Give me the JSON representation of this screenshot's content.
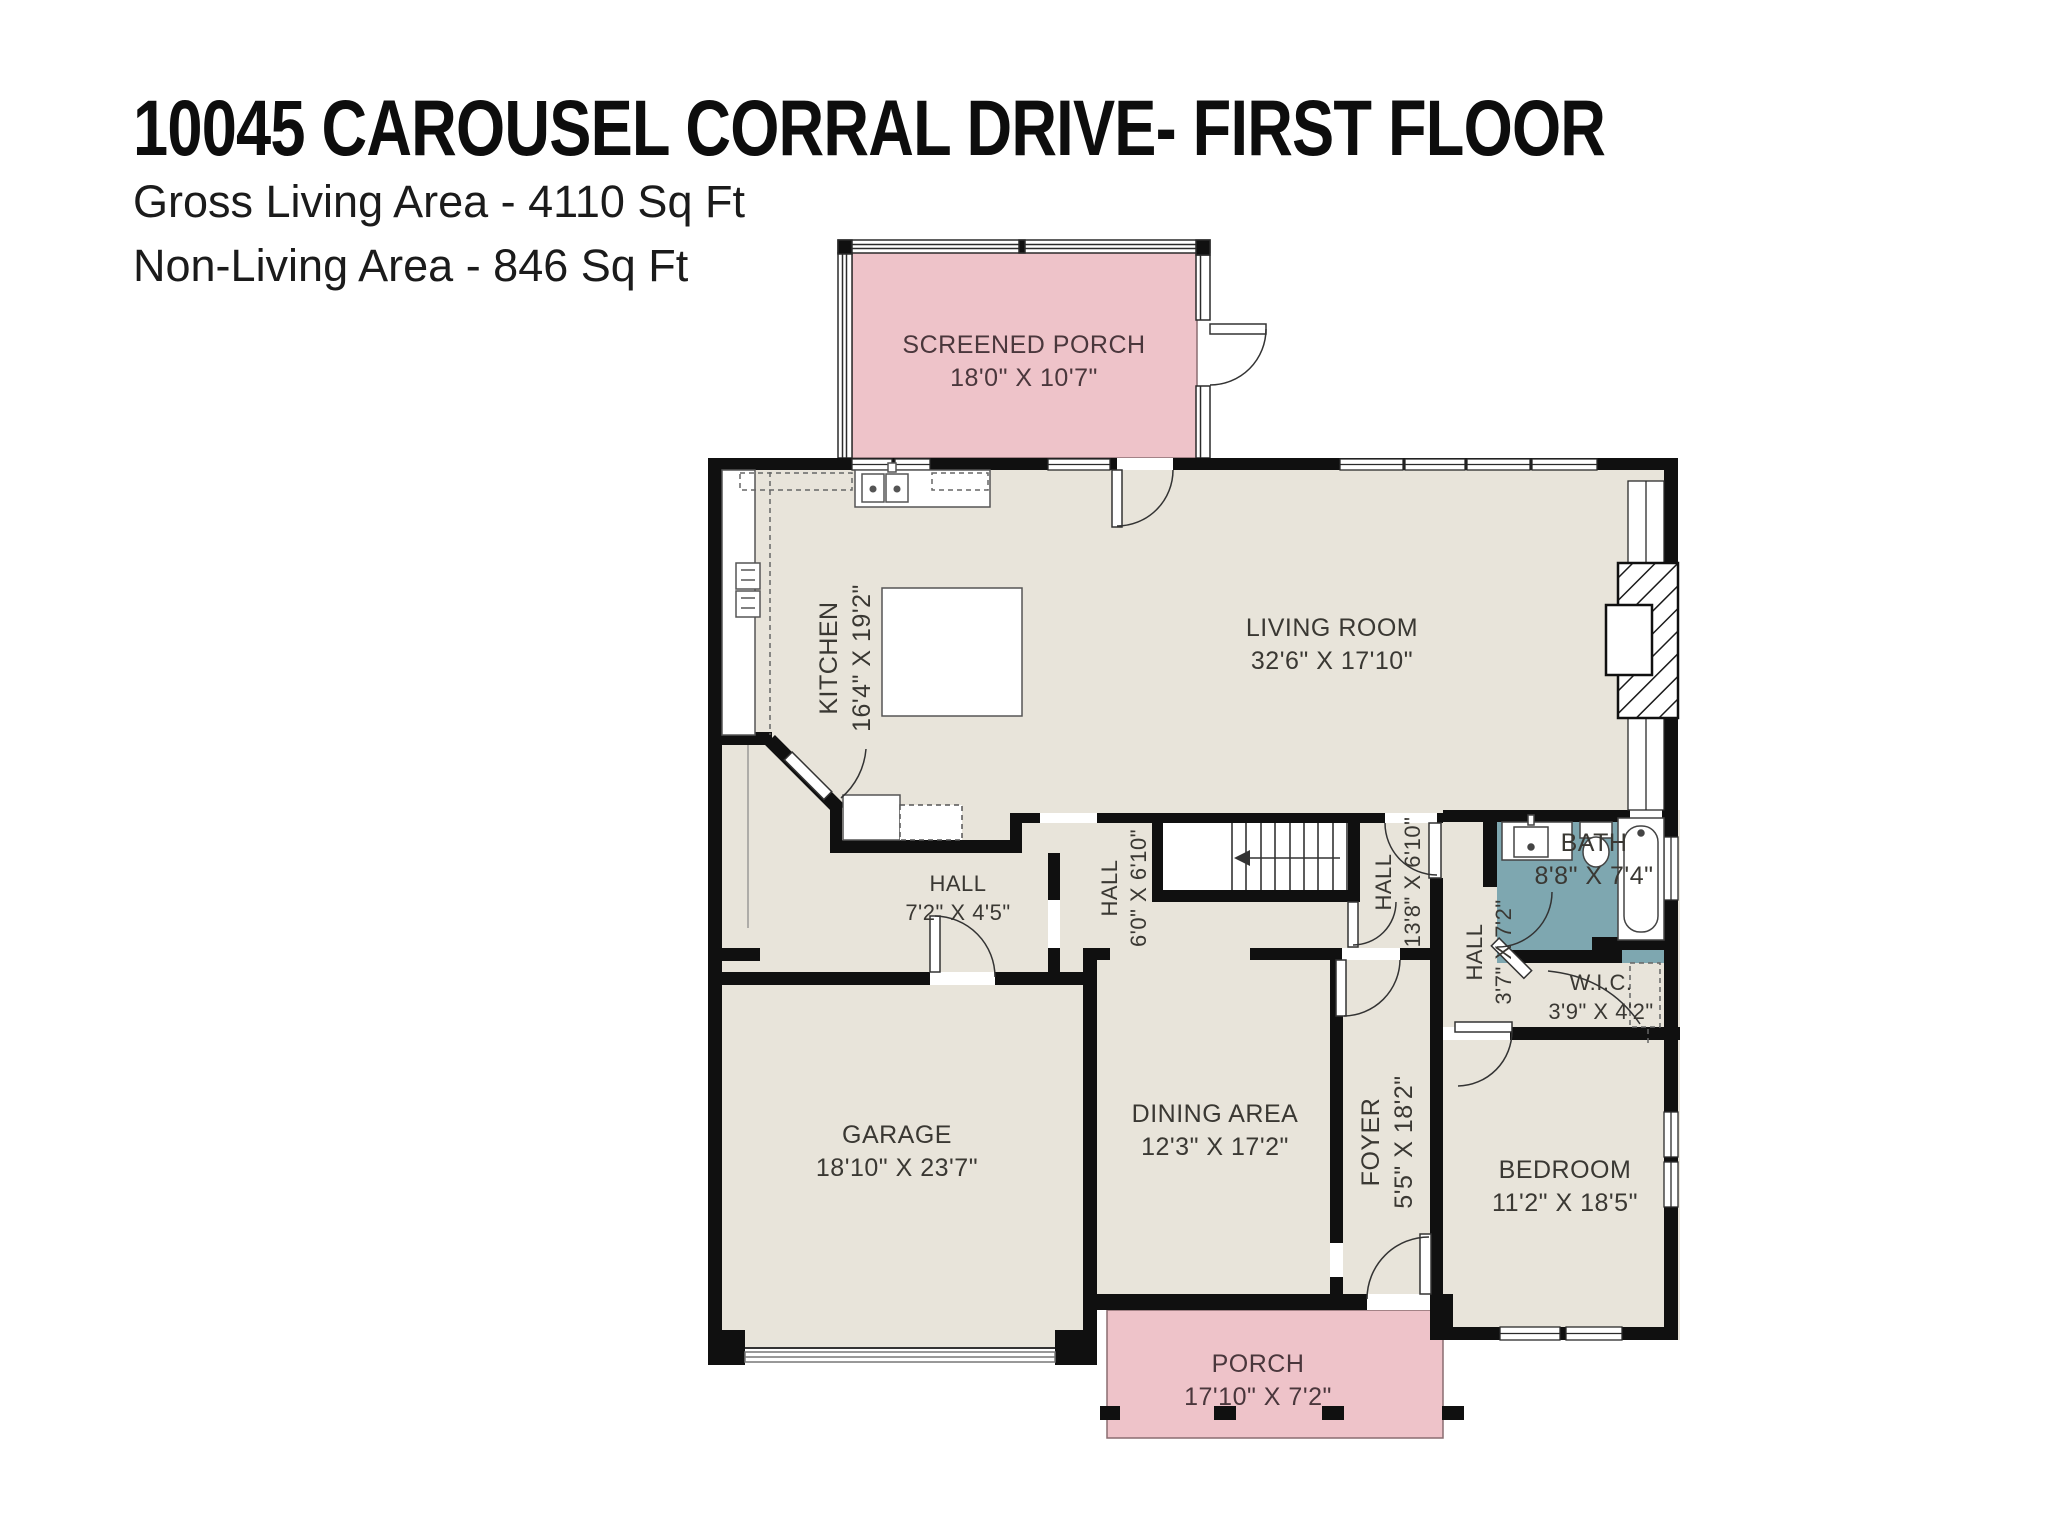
{
  "header": {
    "title": "10045 CAROUSEL CORRAL DRIVE- FIRST FLOOR",
    "gross_living_area": "Gross Living Area - 4110 Sq Ft",
    "non_living_area": "Non-Living Area - 846 Sq Ft"
  },
  "colors": {
    "living_area_fill": "#e8e4da",
    "non_living_fill": "#eec3c9",
    "bath_fill": "#7ea7b0",
    "wall": "#101010"
  },
  "rooms": [
    {
      "id": "screened-porch",
      "name": "SCREENED PORCH",
      "dims": "18'0\" X 10'7\""
    },
    {
      "id": "kitchen",
      "name": "KITCHEN",
      "dims": "16'4\" X 19'2\""
    },
    {
      "id": "living-room",
      "name": "LIVING ROOM",
      "dims": "32'6\" X 17'10\""
    },
    {
      "id": "hall-a",
      "name": "HALL",
      "dims": "7'2\" X 4'5\""
    },
    {
      "id": "hall-b",
      "name": "HALL",
      "dims": "6'0\" X 6'10\""
    },
    {
      "id": "hall-c",
      "name": "HALL",
      "dims": "13'8\" X 6'10\""
    },
    {
      "id": "hall-d",
      "name": "HALL",
      "dims": "3'7\" X 7'2\""
    },
    {
      "id": "bath",
      "name": "BATH",
      "dims": "8'8\" X 7'4\""
    },
    {
      "id": "wic",
      "name": "W.I.C.",
      "dims": "3'9\" X 4'2\""
    },
    {
      "id": "garage",
      "name": "GARAGE",
      "dims": "18'10\" X 23'7\""
    },
    {
      "id": "dining-area",
      "name": "DINING AREA",
      "dims": "12'3\" X 17'2\""
    },
    {
      "id": "foyer",
      "name": "FOYER",
      "dims": "5'5\" X 18'2\""
    },
    {
      "id": "bedroom",
      "name": "BEDROOM",
      "dims": "11'2\" X 18'5\""
    },
    {
      "id": "porch",
      "name": "PORCH",
      "dims": "17'10\" X 7'2\""
    }
  ]
}
